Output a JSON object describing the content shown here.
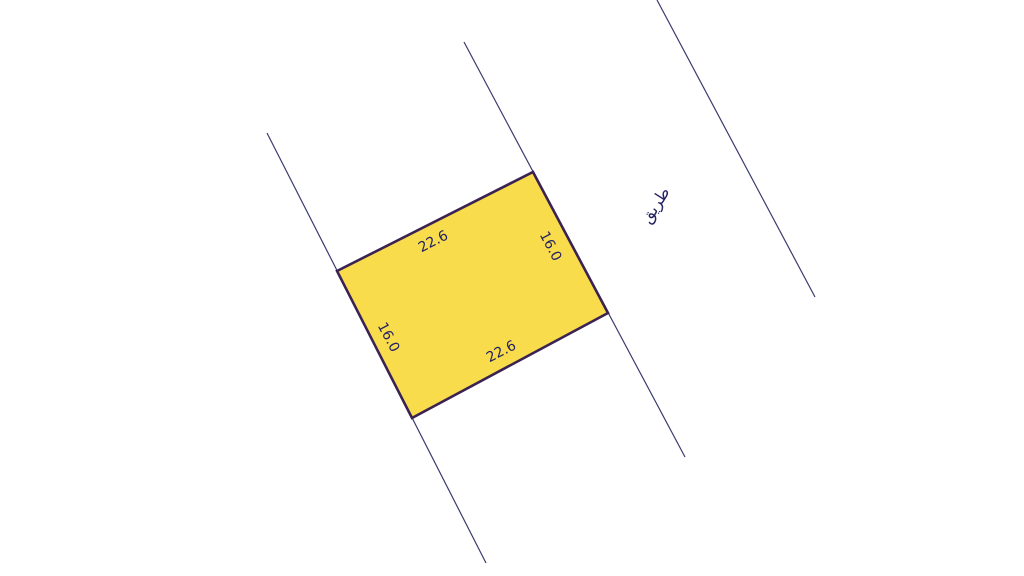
{
  "figure": {
    "type": "cadastral-parcel-sketch",
    "background_color": "#ffffff",
    "parcel": {
      "fill_color": "#f8dc4c",
      "border_color": "#3a2253",
      "dimensions": {
        "top": "22.6",
        "right": "16.0",
        "bottom": "22.6",
        "left": "16.0"
      }
    },
    "road": {
      "label": "طريق"
    },
    "colors": {
      "boundary_line": "#3a3a6e",
      "label_text": "#232163"
    }
  }
}
